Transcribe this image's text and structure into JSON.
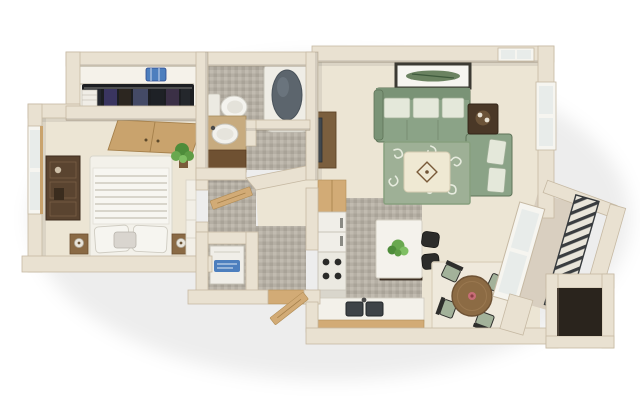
{
  "title": "3D floor plan rendering of a one-bedroom apartment viewed from above",
  "type": "3d-floor-plan",
  "palette": {
    "wall": "#e9e1d1",
    "wallEdge": "#c6b9a3",
    "carpet": "#ece5d4",
    "tileA": "#b5afa4",
    "tileB": "#c1bbb0",
    "tileC": "#a9a398",
    "wood": "#d2ab76",
    "woodDark": "#6f5132",
    "white": "#f3f1ea",
    "dark": "#26221c",
    "sofa": "#8ba387",
    "sofaEdge": "#5f7459",
    "pillow": "#e4e8da",
    "pillowEdge": "#9fae97",
    "rug": "#9eb096",
    "rugScroll": "#eaeee1",
    "ottoman": "#efe9d3",
    "tub": "#5c656d",
    "plant": "#69a84f",
    "plantDark": "#4e8c3a",
    "applianceLabel": "#4d7fbe",
    "rail": "#3a3d40",
    "railBg": "#e9e5da",
    "balconyFloor": "#d9cfc0",
    "glass": "#e8ecea",
    "table": "#8c6b44",
    "cushion": "#a3b29a",
    "chairFrame": "#2e2e2c"
  },
  "rooms": {
    "bedroom": {
      "label": "Bedroom",
      "furniture": [
        "double bed with striped white duvet and pillows",
        "two nightstands with lamps",
        "dark wood dresser",
        "tall window",
        "bifold closet doors",
        "potted plant",
        "wall shelf"
      ]
    },
    "closet": {
      "label": "Closet",
      "furniture": [
        "hanging clothes on rod",
        "top shelf",
        "blue storage bin",
        "folded towels"
      ]
    },
    "bathroom": {
      "label": "Bathroom",
      "furniture": [
        "toilet",
        "vanity with oval sink",
        "bathtub",
        "half wall"
      ]
    },
    "hallway": {
      "label": "Hallway",
      "furniture": [
        "open wood door",
        "diagonal wall"
      ]
    },
    "utility_closet": {
      "label": "Utility closet",
      "furniture": [
        "white appliance with blue label"
      ]
    },
    "entry": {
      "label": "Entry",
      "furniture": [
        "open wood front door",
        "wood threshold"
      ]
    },
    "living_room": {
      "label": "Living room",
      "furniture": [
        "sage L-shaped sectional sofa with patterned pillows",
        "corner end table with tray",
        "cream ottoman with diamond motif",
        "sage scroll-pattern rug",
        "media console with flat-screen TV",
        "framed botanical artwork",
        "windows"
      ]
    },
    "kitchen": {
      "label": "Kitchen",
      "furniture": [
        "tall pantry cabinet",
        "refrigerator",
        "range with four burners",
        "counter with double sink and wood trim",
        "island with plant",
        "two dark bar stools"
      ]
    },
    "dining_area": {
      "label": "Dining area",
      "furniture": [
        "round wood table with pink centerpiece",
        "four chairs with sage cushions",
        "area rug"
      ]
    },
    "balcony": {
      "label": "Balcony",
      "furniture": [
        "sliding glass window",
        "diagonal metal railing",
        "dark storage closet"
      ]
    }
  }
}
